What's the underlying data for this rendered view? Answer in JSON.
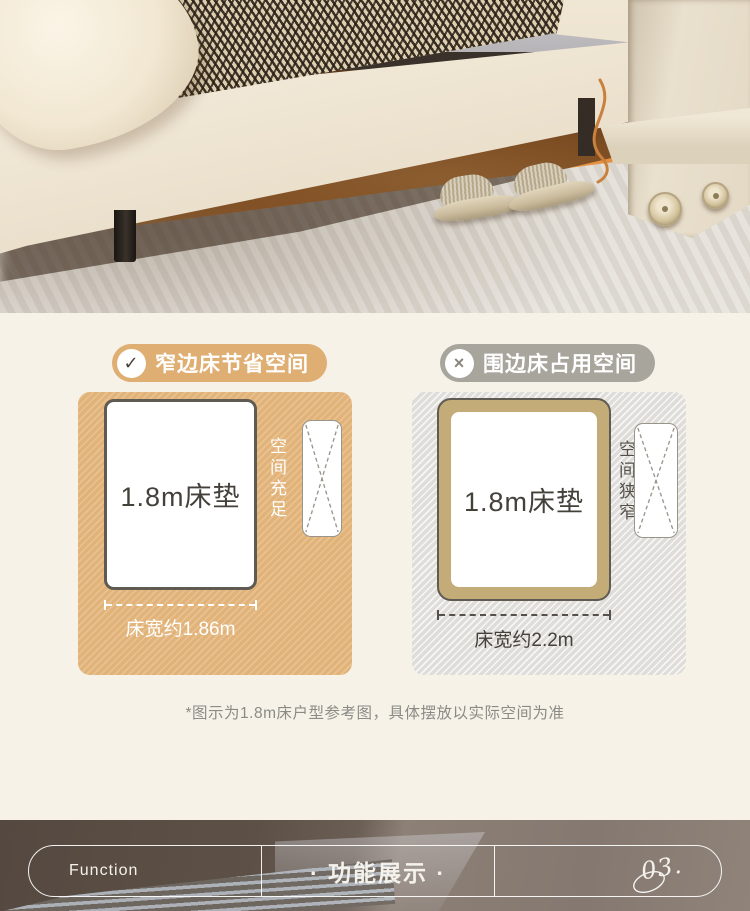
{
  "comparison": {
    "left": {
      "badge_label": "窄边床节省空间",
      "badge_icon": "✓",
      "mattress_label": "1.8m床垫",
      "space_note": "空间充足",
      "width_label": "床宽约1.86m"
    },
    "right": {
      "badge_label": "围边床占用空间",
      "badge_icon": "×",
      "mattress_label": "1.8m床垫",
      "space_note": "空间狭窄",
      "width_label": "床宽约2.2m"
    },
    "footnote": "*图示为1.8m床户型参考图，具体摆放以实际空间为准"
  },
  "footer": {
    "en_label": "Function",
    "cn_label": "· 功能展示 ·",
    "page_number": "03."
  },
  "colors": {
    "page_background": "#F7F2E8",
    "accent_tan": "#DFAE72",
    "muted_gray": "#A8A59D",
    "panel_tan": "#E2B378",
    "panel_gray": "#DEDDD9",
    "bedframe_tan": "#C3AC77",
    "outline_dark": "#5F5B52",
    "text_dark": "#44403A",
    "footnote_gray": "#8B8B86",
    "underbed_glow": "#EE9240"
  }
}
